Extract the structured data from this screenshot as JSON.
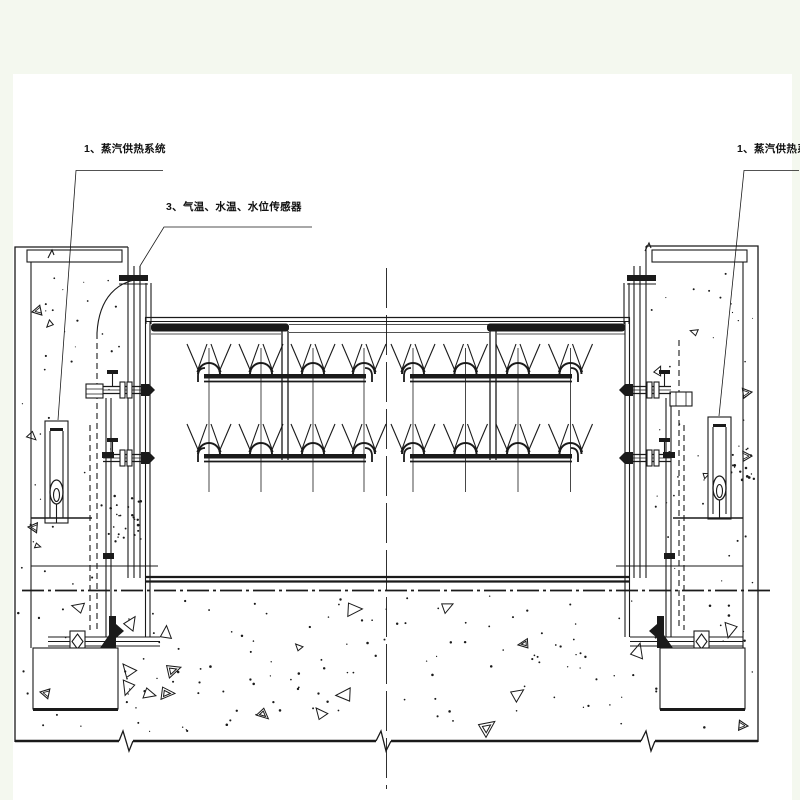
{
  "drawing": {
    "type": "engineering-section-drawing",
    "subject": "gate heating and spray piping between two concrete piers"
  },
  "labels": {
    "steam_left": "1、蒸汽供热系统",
    "sensors": "3、气温、水温、水位传感器",
    "steam_right": "1、蒸汽供热系统"
  },
  "colors": {
    "page_bg": "#f4f8ef",
    "sheet": "#ffffff",
    "ink": "#1a1a1a"
  }
}
